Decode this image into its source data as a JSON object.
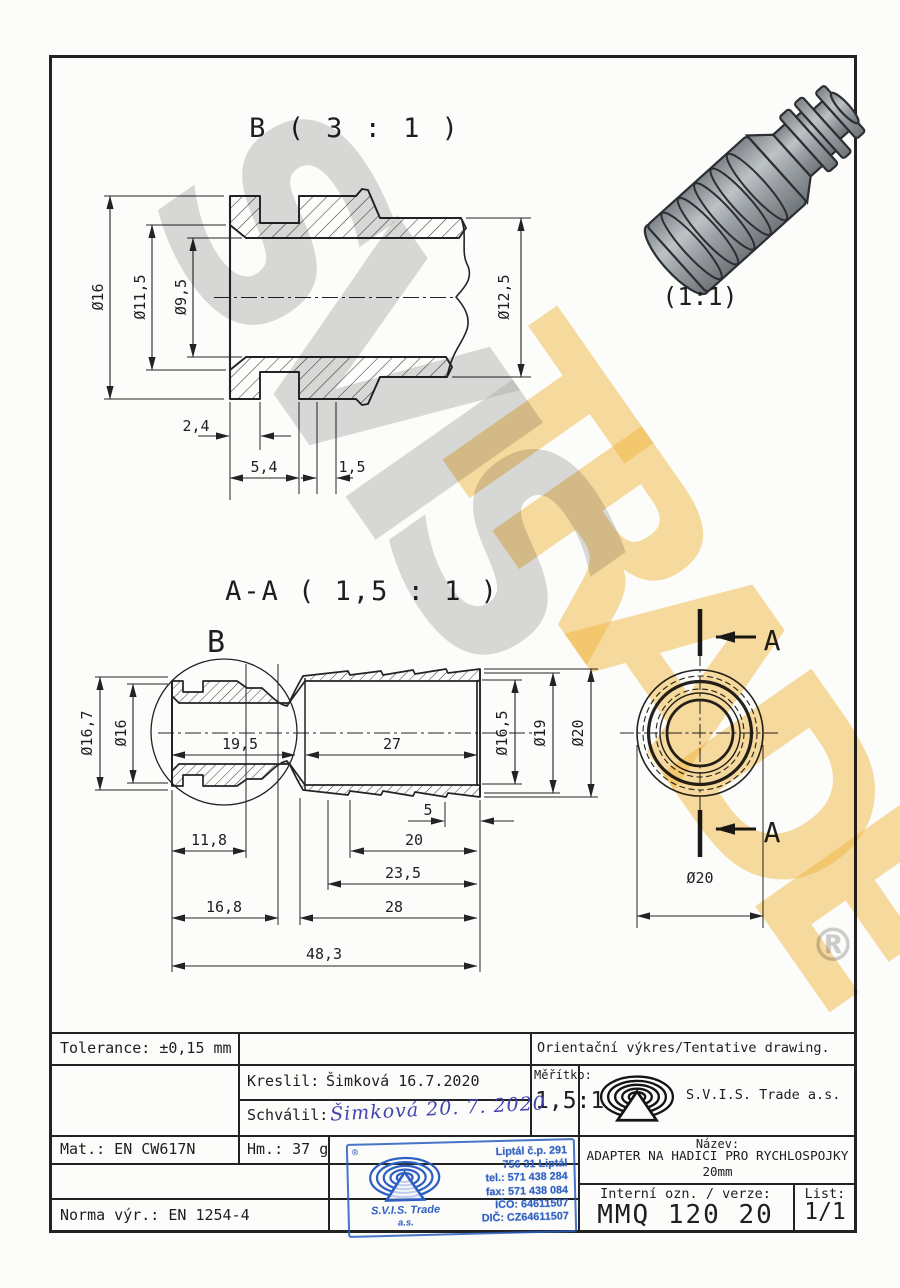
{
  "watermarks": {
    "gray_text": "SVIS",
    "yellow_text": "TRADE",
    "registered": "®"
  },
  "views": {
    "detail_b": {
      "title": "B ( 3 : 1 )",
      "dia_outer": "Ø16",
      "dia_counterbore": "Ø11,5",
      "dia_bore": "Ø9,5",
      "dia_end": "Ø12,5",
      "len_a": "2,4",
      "len_b": "5,4",
      "len_c": "1,5"
    },
    "iso": {
      "scale_label": "(1:1)"
    },
    "section": {
      "title": "A-A ( 1,5 : 1 )",
      "detail_marker": "B",
      "dia_flange": "Ø16,7",
      "dia_body": "Ø16",
      "len_bore": "19,5",
      "len_barb_bore": "27",
      "dia_barb_bore": "Ø16,5",
      "dia_barb_min": "Ø19",
      "dia_barb_max": "Ø20",
      "len_tip": "5",
      "len_a": "11,8",
      "len_b": "20",
      "len_c": "23,5",
      "len_d": "16,8",
      "len_e": "28",
      "len_total": "48,3"
    },
    "end_view": {
      "section_label_top": "A",
      "section_label_bottom": "A",
      "dia": "Ø20"
    }
  },
  "title_block": {
    "tolerance": "Tolerance: ±0,15 mm",
    "drawing_type": "Orientační výkres/Tentative drawing.",
    "drawn_label": "Kreslil:",
    "drawn_value": "Šimková 16.7.2020",
    "approved_label": "Schválil:",
    "approved_signature": "Šimková 20. 7. 2020",
    "scale_label": "Měřítko:",
    "scale_value": "1,5:1",
    "company": "S.V.I.S. Trade a.s.",
    "material": "Mat.: EN CW617N",
    "weight": "Hm.: 37 g",
    "standard": "Norma výr.: EN 1254-4",
    "name_label": "Název:",
    "name_line1": "ADAPTER NA HADICI PRO RYCHLOSPOJKY",
    "name_line2": "20mm",
    "internal_label": "Interní ozn. / verze:",
    "internal_value": "MMQ 120 20",
    "sheet_label": "List:",
    "sheet_value": "1/1"
  },
  "stamp": {
    "registered": "®",
    "company": "S.V.I.S. Trade",
    "company_suffix": "a.s.",
    "address_line1": "Liptál č.p. 291",
    "address_line2": "756 31 Liptál",
    "tel": "tel.: 571 438 284",
    "fax": "fax: 571 438 084",
    "ico": "IČO: 64611507",
    "dic": "DIČ: CZ64611507"
  },
  "colors": {
    "line": "#232323",
    "paper": "#fcfcfa",
    "stamp_blue": "#2e5fc2",
    "signature_ink": "#4343b0",
    "watermark_gray": "#acacac",
    "watermark_yellow": "#f3ba42"
  }
}
